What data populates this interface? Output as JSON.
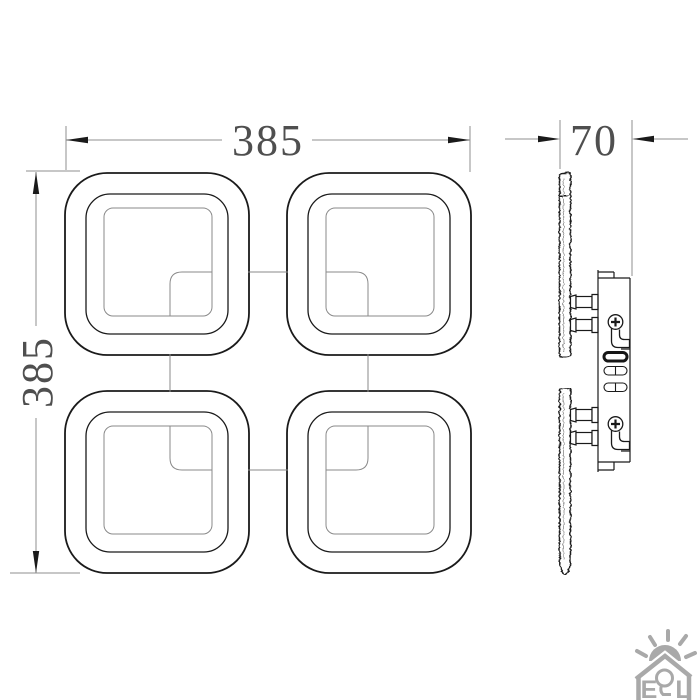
{
  "drawing": {
    "type": "luminaire dimension drawing",
    "front_view": {
      "width_label": "385",
      "height_label": "385",
      "modules": 4,
      "module_shape": "rounded square ring with mosaic mesh texture"
    },
    "side_view": {
      "depth_label": "70"
    }
  },
  "logo": {
    "letter_e": "E",
    "letter_l": "L",
    "middle_glyph": "lightbulb"
  },
  "colors": {
    "line": "#1a1a1a",
    "dim_line": "#8f8f8f",
    "dim_text": "#4f4f4f",
    "detail_line": "#8a8a8a",
    "logo": "#a9a9a9"
  }
}
